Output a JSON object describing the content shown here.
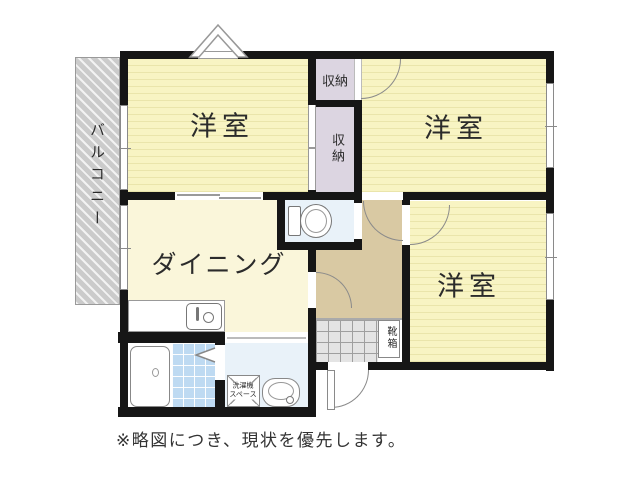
{
  "title": "floor-plan",
  "labels": {
    "bedroom1": "洋室",
    "bedroom2": "洋室",
    "bedroom3": "洋室",
    "dining": "ダイニング",
    "closet_top": "収納",
    "closet_side": "収納",
    "balcony": "バルコニー",
    "shoe_box": "靴箱",
    "washer_line1": "洗濯機",
    "washer_line2": "スペース"
  },
  "note": "※略図につき、現状を優先します。",
  "icons": [
    "toilet-icon",
    "bathtub-icon",
    "kitchen-sink-icon",
    "washbasin-icon",
    "washer-space-icon",
    "bay-window-icon",
    "folding-door-icon",
    "door-arc-icon"
  ],
  "colors": {
    "wall": "#161616",
    "room": "#f8f4c3",
    "stripe": "#eae5ab",
    "dining": "#faf6da",
    "closet": "#dcd5e1",
    "hall": "#d9c9a3",
    "wet": "#e9f2f9",
    "tile": "#bedaf2",
    "balcony": "#cbcbcb",
    "entry": "#e4e4e4",
    "ink": "#2b2b2b"
  }
}
